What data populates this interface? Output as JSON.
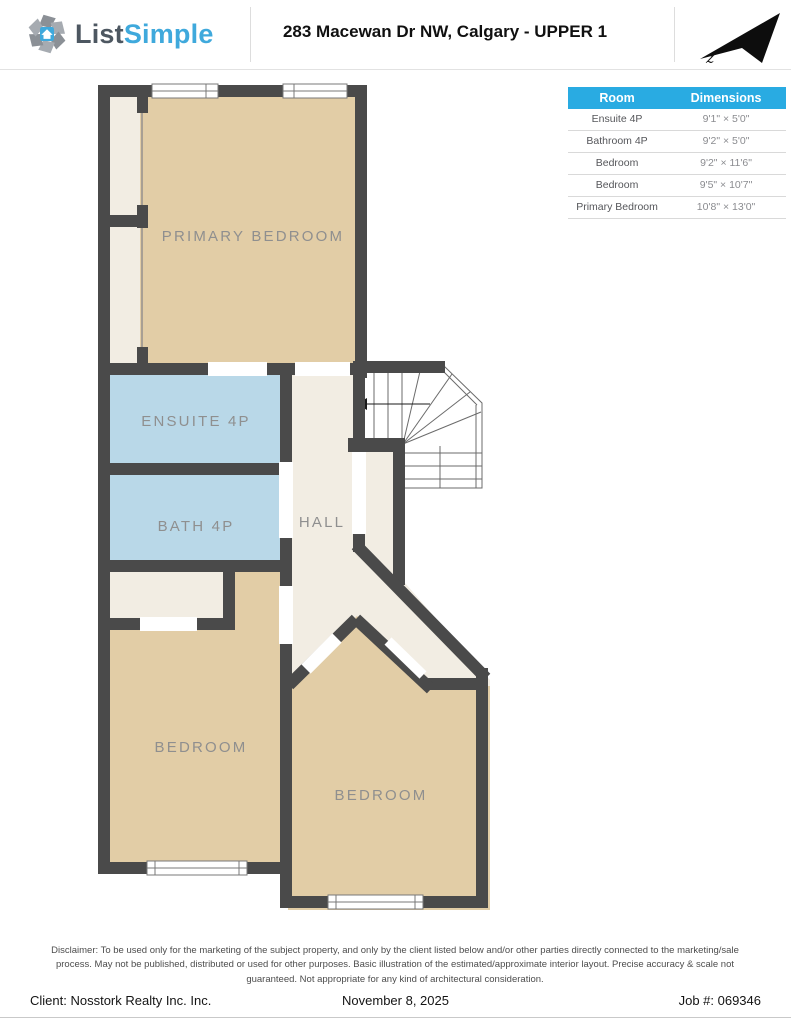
{
  "header": {
    "logo": {
      "word1": "List",
      "word2": "Simple"
    },
    "title": "283 Macewan Dr NW, Calgary - UPPER 1",
    "compass_letter": "z"
  },
  "plan": {
    "labels": {
      "primary_bedroom": "PRIMARY BEDROOM",
      "ensuite": "ENSUITE 4P",
      "bath": "BATH 4P",
      "hall": "HALL",
      "bedroom_left": "BEDROOM",
      "bedroom_right": "BEDROOM"
    },
    "colors": {
      "wall": "#4a4a4a",
      "bedroom_fill": "#e2cda6",
      "bathroom_fill": "#b9d8e8",
      "hall_fill": "#f2ede3",
      "label_text": "#8f8f8f"
    }
  },
  "dimensions_table": {
    "headers": {
      "room": "Room",
      "dimensions": "Dimensions"
    },
    "header_bg": "#29abe2",
    "rows": [
      {
        "room": "Ensuite 4P",
        "dimensions": "9'1\" × 5'0\""
      },
      {
        "room": "Bathroom 4P",
        "dimensions": "9'2\" × 5'0\""
      },
      {
        "room": "Bedroom",
        "dimensions": "9'2\" × 11'6\""
      },
      {
        "room": "Bedroom",
        "dimensions": "9'5\" × 10'7\""
      },
      {
        "room": "Primary Bedroom",
        "dimensions": "10'8\" × 13'0\""
      }
    ]
  },
  "disclaimer": "Disclaimer: To be used only for the marketing of the subject property, and only by the client listed below and/or other parties directly connected to the marketing/sale process. May not be published, distributed or used for other purposes. Basic illustration of the estimated/approximate interior layout. Precise accuracy & scale not guaranteed. Not appropriate for any kind of architectural consideration.",
  "footer": {
    "client": "Client: Nosstork Realty Inc. Inc.",
    "date": "November 8, 2025",
    "job": "Job #: 069346"
  }
}
